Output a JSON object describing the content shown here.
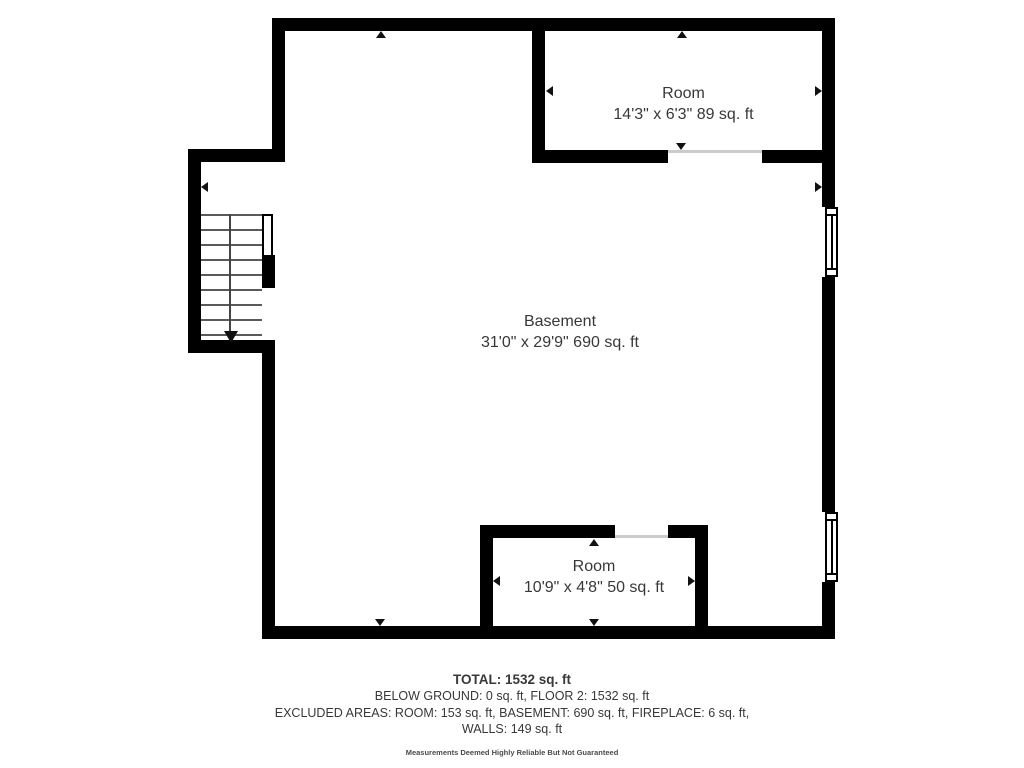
{
  "plan": {
    "rooms": [
      {
        "id": "room-upper-right",
        "name": "Room",
        "dims": "14'3\" x 6'3\" 89 sq. ft"
      },
      {
        "id": "basement",
        "name": "Basement",
        "dims": "31'0\" x 29'9\" 690 sq. ft"
      },
      {
        "id": "room-lower-middle",
        "name": "Room",
        "dims": "10'9\" x 4'8\" 50 sq. ft"
      }
    ],
    "icons": {
      "dimension_arrow": "small solid black triangle marker on wall",
      "stairs_down_arrow": "black triangle at end of stair centerline",
      "window": "white double-line window symbol in wall",
      "stairs": "parallel gray tread lines with centerline"
    }
  },
  "footer": {
    "total": "TOTAL: 1532 sq. ft",
    "line_below_ground": "BELOW GROUND: 0 sq. ft, FLOOR 2: 1532 sq. ft",
    "line_excluded": "EXCLUDED AREAS: ROOM: 153 sq. ft, BASEMENT: 690 sq. ft, FIREPLACE: 6 sq. ft,",
    "line_walls": "WALLS: 149 sq. ft",
    "disclaimer": "Measurements Deemed Highly Reliable But Not Guaranteed"
  },
  "colors": {
    "wall": "#000000",
    "text": "#383838",
    "tread": "#5a5a5a",
    "opening": "#cccccc",
    "background": "#ffffff"
  }
}
